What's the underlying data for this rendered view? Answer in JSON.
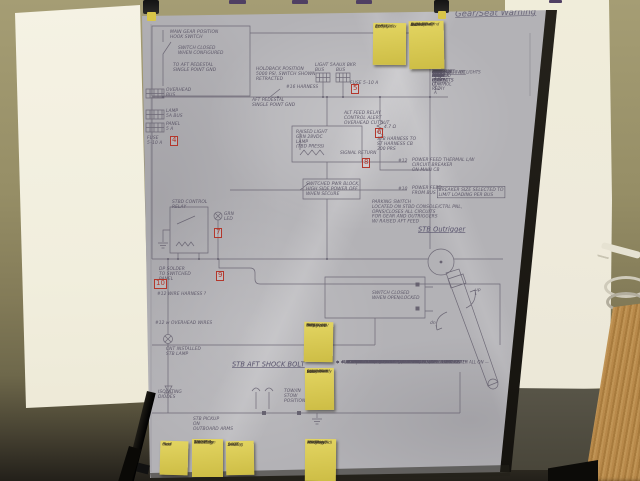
{
  "sheet": {
    "corner_title": "Gear/Seat Warning",
    "outrigger_title": "STB Outrigger",
    "shock_bolt_title": "STB AFT SHOCK BOLT",
    "edge_note": "C&M / DWG — Outriggers",
    "labels": {
      "main_gear": "MAIN GEAR POSITION\nHOOK SWITCH",
      "switch_cfg": "SWITCH CLOSED\nWHEN CONFIGURED",
      "to_aft": "TO AFT PEDESTAL\nSINGLE POINT GND",
      "overhead_bus": "OVERHEAD\nBUS",
      "lamp_bus": "LAMP\n5A BUS",
      "panel_bus": "PANEL\n5 A",
      "fuse_left": "FUSE\n5–10 A",
      "holdback": "HOLDBACK POSITION\n5000 PSI, SWITCH SHOWN\nRETRACTED",
      "aft_gnd": "AFT PEDESTAL\nSINGLE POINT GND",
      "light_bus": "LIGHT 5A\nBUS",
      "aux_bus": "AUX BKR\nBUS",
      "fuse_right": "FUSE 5–10 A",
      "harness16": "#16 HARNESS",
      "alt_feed": "ALT FEED RELAY\nCONTROL ALERT\nOVERHEAD CUTOUT",
      "raised_light": "RAISED LIGHT\nGRN 28VDC\nLAMP\n(TBD PRESS)",
      "stb_harness": "STB HARNESS TO\nST HARNESS CB\n300 PRS",
      "resistor": "4.7 Ω",
      "signal_return": "SIGNAL RETURN",
      "feed12_tag": "#12",
      "feed12_txt": "POWER FEED THERMAL L/W\nCIRCUIT BREAKER\nON MAIN CB",
      "feed10_tag": "#10",
      "feed10_txt": "POWER FEED\nFROM BUS",
      "breaker_note": "BREAKER SIZE SELECTED TO\nLIMIT LOADING PER BUS",
      "switched_block": "SWITCHED PWR BLOCK,\nHIGH SIDE POWER OFF\nWHEN SECURE",
      "parking": "PARKING SWITCH\nLOCATED ON STBD CONSOLE/CTRL PNL,\nOPNS/CLOSES ALL CIRCUITS\nFOR GEAR AND OUTRIGGERS\nW/ RAISED AFT FEED",
      "overhead_wires": "#12 w OVERHEAD WIRES",
      "cnt_installed": "CNT INSTALLED\nSTB LAMP",
      "isolating": "ISOLATING\nDIODES",
      "tow_stow": "TOW/IN\nSTOW\nPOSITION",
      "stb_pickup": "STB PICKUP\nON\nOUTBOARD ARMS",
      "switch_open": "SWITCH CLOSED\nWHEN OPEN/LOCKED",
      "stbd_relay": "STBD CONTROL\nRELAY",
      "grn_led": "GRN\nLED",
      "dp_solder": "DP SOLDER\nTO SWITCHED\nPANEL",
      "wire_harness": "#12 WIRE HARNESS ?",
      "up": "up",
      "dn": "dn"
    },
    "flags": [
      "4",
      "5",
      "6",
      "8",
      "7",
      "9",
      "10"
    ],
    "load_table": {
      "header": "LOADS @ 28VDC",
      "rows": [
        {
          "label": "MOTOR AND BRAKE\nCONTR RELAY",
          "value": "1.5 amp"
        },
        {
          "label": "TIME DELAY RELAY",
          "value": ".05 amp"
        },
        {
          "label": "TIME DELAY RELAY",
          "value": "1/3 amp"
        },
        {
          "label": "PRESSURE RELAY",
          "value": "1/2 amp"
        },
        {
          "label": "PT/STB MAIN RELAY\nCONTROL",
          "value": "50 mA"
        },
        {
          "label": "ANTENNA RELAY",
          "value": "1/2 amp"
        },
        {
          "label": "MAIN READY LT",
          "value": "10 mA"
        },
        {
          "label": "TWO DOWN LOCKED LT",
          "value": "20 mA"
        },
        {
          "label": "STBD/PORT UP LOCK\nCONTACTS",
          "value": "40 mA"
        },
        {
          "label": "ALT & MAIN IND\nCONTACTS",
          "value": "100 mA"
        }
      ],
      "total_label": "TOTAL",
      "total_value": "≈ 4.5 / 5.2 A",
      "total_note": "@ 28 VDC — NO LIGHTS"
    },
    "checklist": {
      "lines": [
        "✱  MINIMUM ELEVATION / MINIMUM DRAW :",
        "      – MAIN BOAT SWITCH OFF",
        "      – IF BAT NOT FEED/BATT'Y SIDE ON MAIN BOAT – OK",
        "      – IF BAT ALT FEED/BAT BUS FEED OFF BUT WIRE IF BAT ON",
        "      – 3 BANK BREAKERS PULLED, ALTERNATE – PULL PUMP #1",
        "      – BOT JUST MAIN (STORED DISPLAYED OFF)",
        "✱  FULL FUNCTION / RUNNING FROM MAIN BOAT :",
        "      – MAIN BOAT SWITCH ON",
        "      – PARKING SWITCH OFF",
        "      – 3 BUS BREAKERS PULLED, ALTERNATE – TDR – PUMP #2",
        "✱  FULL FUNCTION / POWERING MAIN BAL :",
        "      – MAIN BOAT SWITCH OFF",
        "      – PARKING SWITCH OFF",
        "      – IF BUS BREAKERS PULLED, ALTERNATE – FULL PUMP #1",
        "✱ ✱ ✱  NOTE : WITH BOAT SHORE WIRED, PANEL LIGHTS/MASTER ALL ON —",
        "          THIS ASSUMES WITH WIRING CIRCUIT IS WIRED BACK WITH",
        "          CIRCUIT AND SHAKER.   SEE AS TAG IN/WIRE THIS PLUG"
      ]
    }
  },
  "sticky_notes": [
    {
      "lines": [
        "SESTID Fix",
        "Body?",
        "(JJ Relys",
        "Run it Pot",
        "Arr?"
      ]
    },
    {
      "lines": [
        "Midway,",
        "N Dr & Pot",
        "Re inf fine",
        "Dist?",
        "Cut off Rely",
        "So Move off",
        "w/SR Rel Grnd"
      ]
    },
    {
      "lines": [
        "WRL",
        "energized",
        "Rley = 28V",
        "to PJ up +",
        "Hold, Rold",
        "off SP to",
        "Pins-B off"
      ]
    },
    {
      "lines": [
        "WRL",
        "Relay: Pot",
        "Roll off +",
        "Sch dn/Rnd",
        "Stows? old",
        "w/ bll wire",
        "RedFdbk Rly",
        "State indic"
      ]
    },
    {
      "lines": [
        "med",
        "next",
        "Cut-l",
        "files"
      ]
    },
    {
      "lines": [
        "1 h st",
        "3w/3w Fan",
        "BNC wbl",
        "WiresTray",
        "WireCods",
        "note Rug"
      ]
    },
    {
      "lines": [
        "Selut",
        "3m(L)y",
        "DPDT",
        "Sw Flag"
      ]
    },
    {
      "lines": [
        "next ton",
        "read bay?",
        "revGr ly bk",
        "shit/Pow/",
        "Rangles(old)",
        "TB DP dr",
        "w-ll Blvg"
      ]
    }
  ],
  "colors": {
    "wall": "#948c64",
    "poster_board": "#f3f0e1",
    "sheet_paper": "#b3b2b6",
    "pencil": "#5c5768",
    "flag_red": "#b3372c",
    "sticky_note": "#d9ca52",
    "wood": "#b8894a"
  }
}
